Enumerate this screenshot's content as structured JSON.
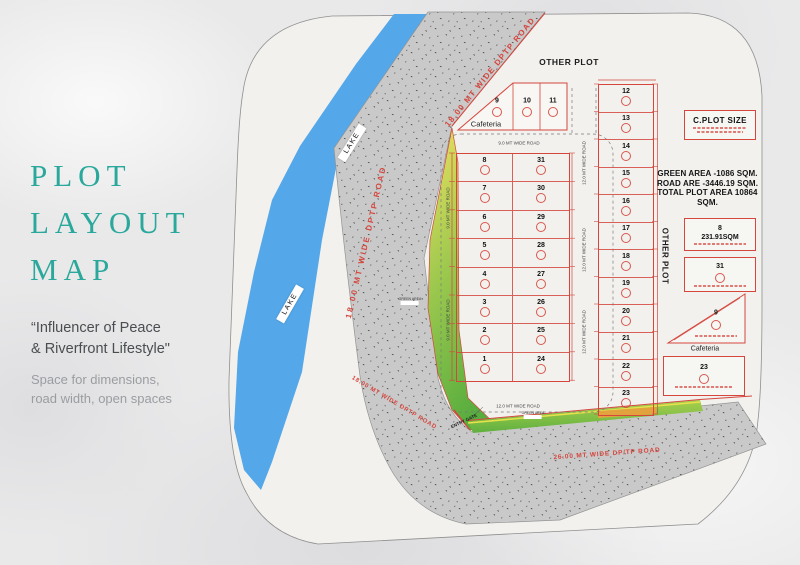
{
  "panel": {
    "title_line1": "PLOT",
    "title_line2": "LAYOUT",
    "title_line3": "MAP",
    "quote_line1": "“Influencer of Peace",
    "quote_line2": "& Riverfront Lifestyle\"",
    "desc_line1": "Space for dimensions,",
    "desc_line2": "road width, open spaces"
  },
  "map": {
    "labels": {
      "other_plot_top": "OTHER PLOT",
      "other_plot_side": "OTHER PLOT",
      "lake": "LAKE",
      "entry_gate": "ENTRY GATE",
      "green_area": "GREEN AREA",
      "cafeteria": "Cafeteria"
    },
    "roads": {
      "dptp_18": "18.00 MT WIDE DPTP ROAD",
      "dptp_26": "26.00 MT WIDE DP/TP ROAD",
      "wide_9": "9.0 MT WIDE ROAD",
      "wide_12": "12.0 MT WIDE ROAD"
    },
    "stats_line1": "GREEN AREA -1086 SQM.",
    "stats_line2": "ROAD ARE -3446.19 SQM.",
    "stats_line3": "TOTAL PLOT AREA 10864 SQM.",
    "top_row": [
      {
        "num": "9",
        "note": "Cafeteria"
      },
      {
        "num": "10"
      },
      {
        "num": "11"
      }
    ],
    "central_rows": [
      [
        "8",
        "31"
      ],
      [
        "7",
        "30"
      ],
      [
        "6",
        "29"
      ],
      [
        "5",
        "28"
      ],
      [
        "4",
        "27"
      ],
      [
        "3",
        "26"
      ],
      [
        "2",
        "25"
      ],
      [
        "1",
        "24"
      ]
    ],
    "right_column": [
      "12",
      "13",
      "14",
      "15",
      "16",
      "17",
      "18",
      "19",
      "20",
      "21",
      "22",
      "23"
    ],
    "details": {
      "c_plot_size": "C.PLOT SIZE",
      "plot8_num": "8",
      "plot8_area": "231.91SQM",
      "plot31_num": "31",
      "plot9_num": "9",
      "plot9_note": "Cafeteria",
      "plot23_num": "23"
    },
    "colors": {
      "accent_teal": "#2ba89c",
      "plot_red": "#d5463d",
      "lake_blue": "#54a7e8",
      "road_gray": "#cac9c9",
      "green": "#6ab544"
    }
  }
}
